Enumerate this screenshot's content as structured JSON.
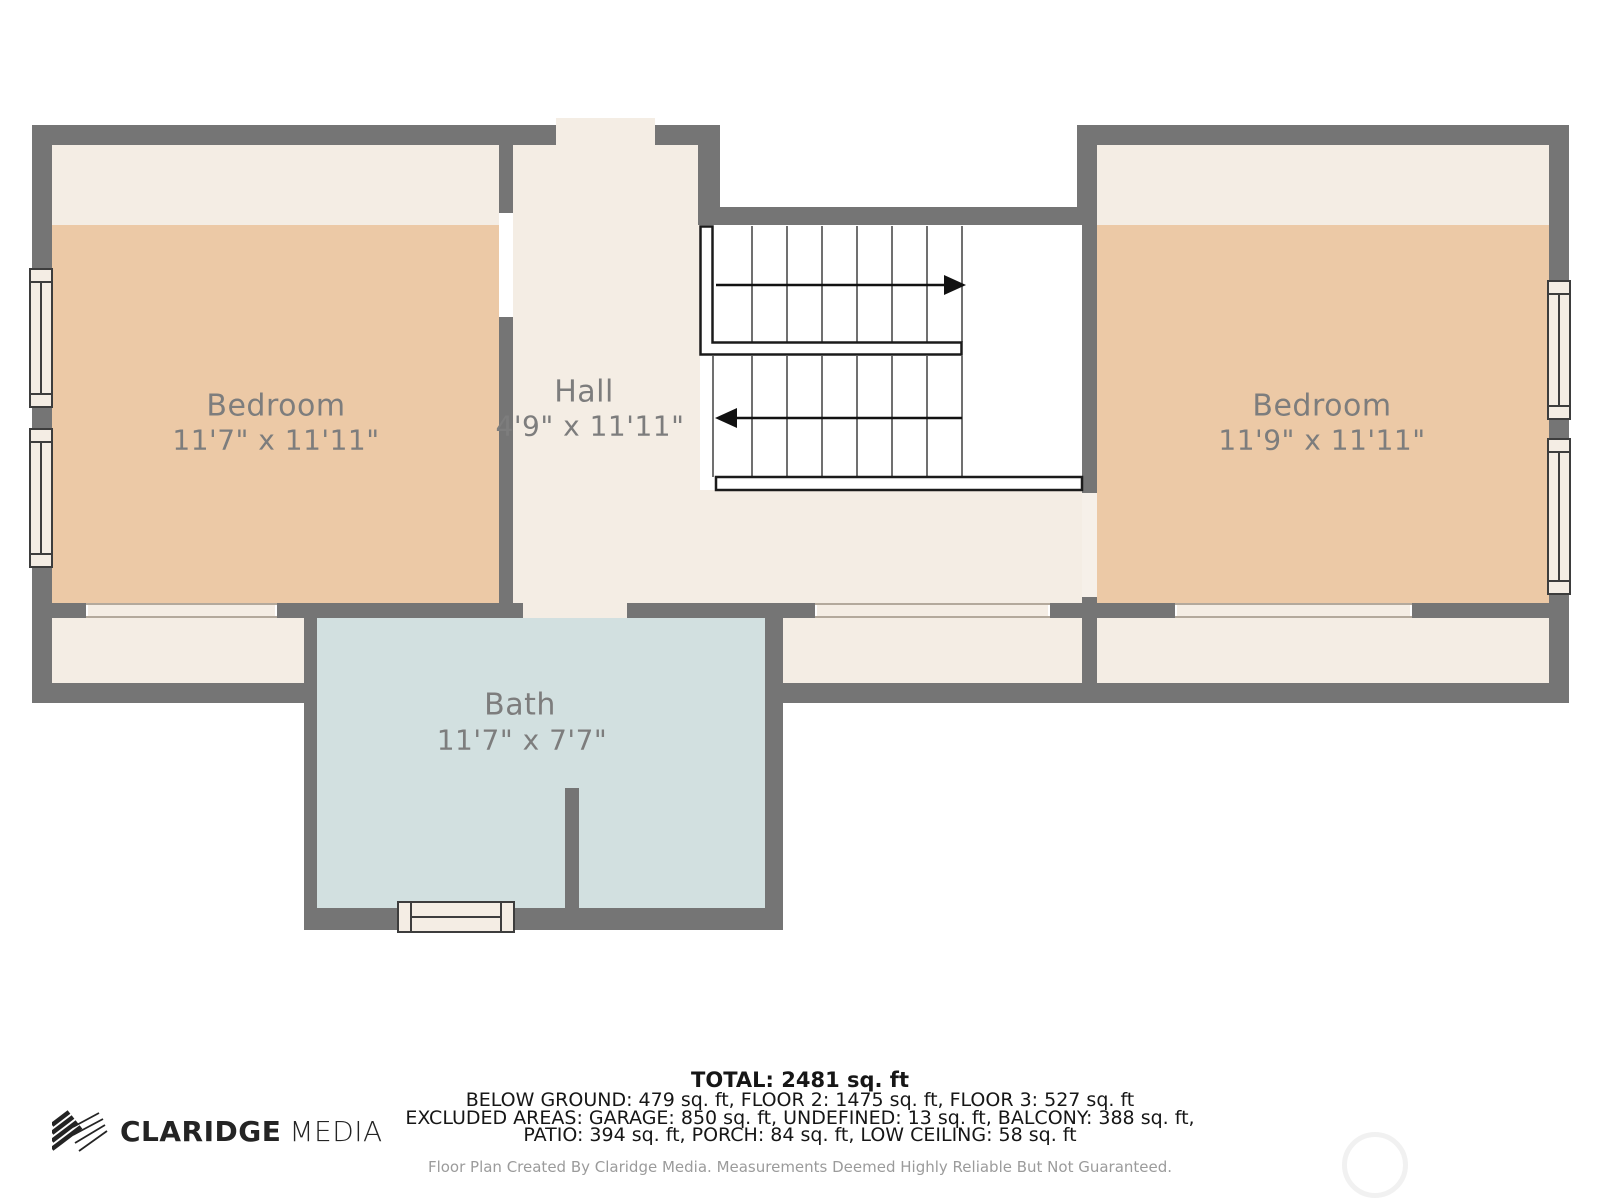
{
  "plan": {
    "rooms": {
      "bedroom_left": {
        "label": "Bedroom",
        "dims": "11'7\" x 11'11\""
      },
      "hall": {
        "label": "Hall",
        "dims": "4'9\" x 11'11\""
      },
      "bedroom_right": {
        "label": "Bedroom",
        "dims": "11'9\" x 11'11\""
      },
      "bath": {
        "label": "Bath",
        "dims": "11'7\" x 7'7\""
      }
    },
    "stairs": {
      "up_arrow_icon": "stair-arrow-right",
      "down_arrow_icon": "stair-arrow-left"
    },
    "colors": {
      "wall": "#757575",
      "floor_cream": "#f4ede4",
      "bedroom_tan": "#ecc9a6",
      "bath_blue": "#d2e0e0",
      "label_text": "#7d7d7d"
    }
  },
  "footer": {
    "total": "TOTAL: 2481 sq. ft",
    "areas_line1": "BELOW GROUND: 479 sq. ft, FLOOR 2: 1475 sq. ft, FLOOR 3: 527 sq. ft",
    "areas_line2": "EXCLUDED AREAS: GARAGE: 850 sq. ft, UNDEFINED: 13 sq. ft, BALCONY: 388 sq. ft,",
    "areas_line3": "PATIO: 394 sq. ft, PORCH: 84 sq. ft, LOW CEILING: 58 sq. ft",
    "disclaimer": "Floor Plan Created By Claridge Media. Measurements Deemed Highly Reliable But Not Guaranteed."
  },
  "logo": {
    "brand": "CLARIDGE",
    "suffix": "MEDIA"
  }
}
